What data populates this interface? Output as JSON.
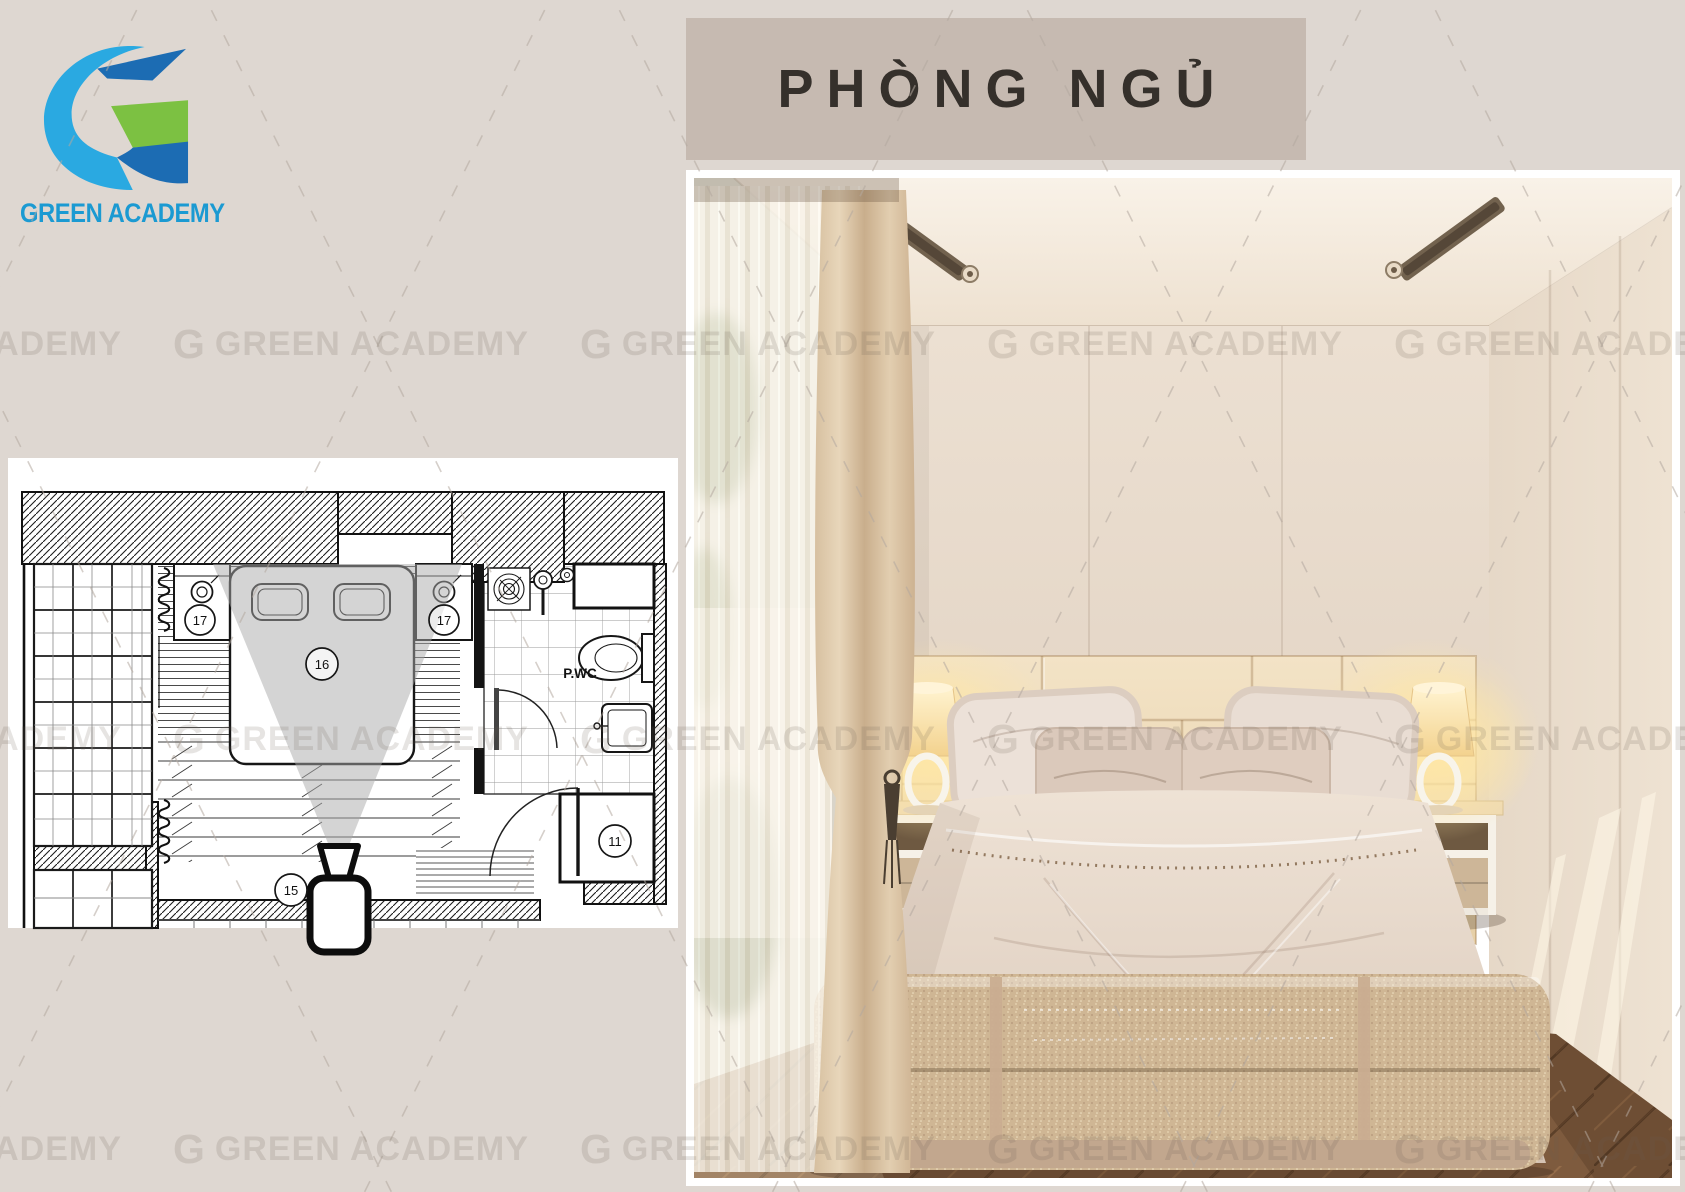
{
  "page": {
    "background": "#ded7d1"
  },
  "logo": {
    "brand": "GREEN ACADEMY",
    "text_color": "#1b9ad2",
    "mark_colors": {
      "light_blue": "#2aa9e1",
      "dark_blue": "#1c6cb3",
      "green": "#7cc142"
    }
  },
  "title_banner": {
    "text": "PHÒNG NGỦ",
    "background": "#c6bab1",
    "text_color": "#35302b"
  },
  "floor_plan": {
    "room_label": "P.WC",
    "callouts": {
      "bed": "16",
      "nightstand_left": "17",
      "nightstand_right": "17",
      "camera": "15",
      "door": "11"
    }
  },
  "watermark": {
    "glyph": "G",
    "text": "GREEN ACADEMY"
  }
}
